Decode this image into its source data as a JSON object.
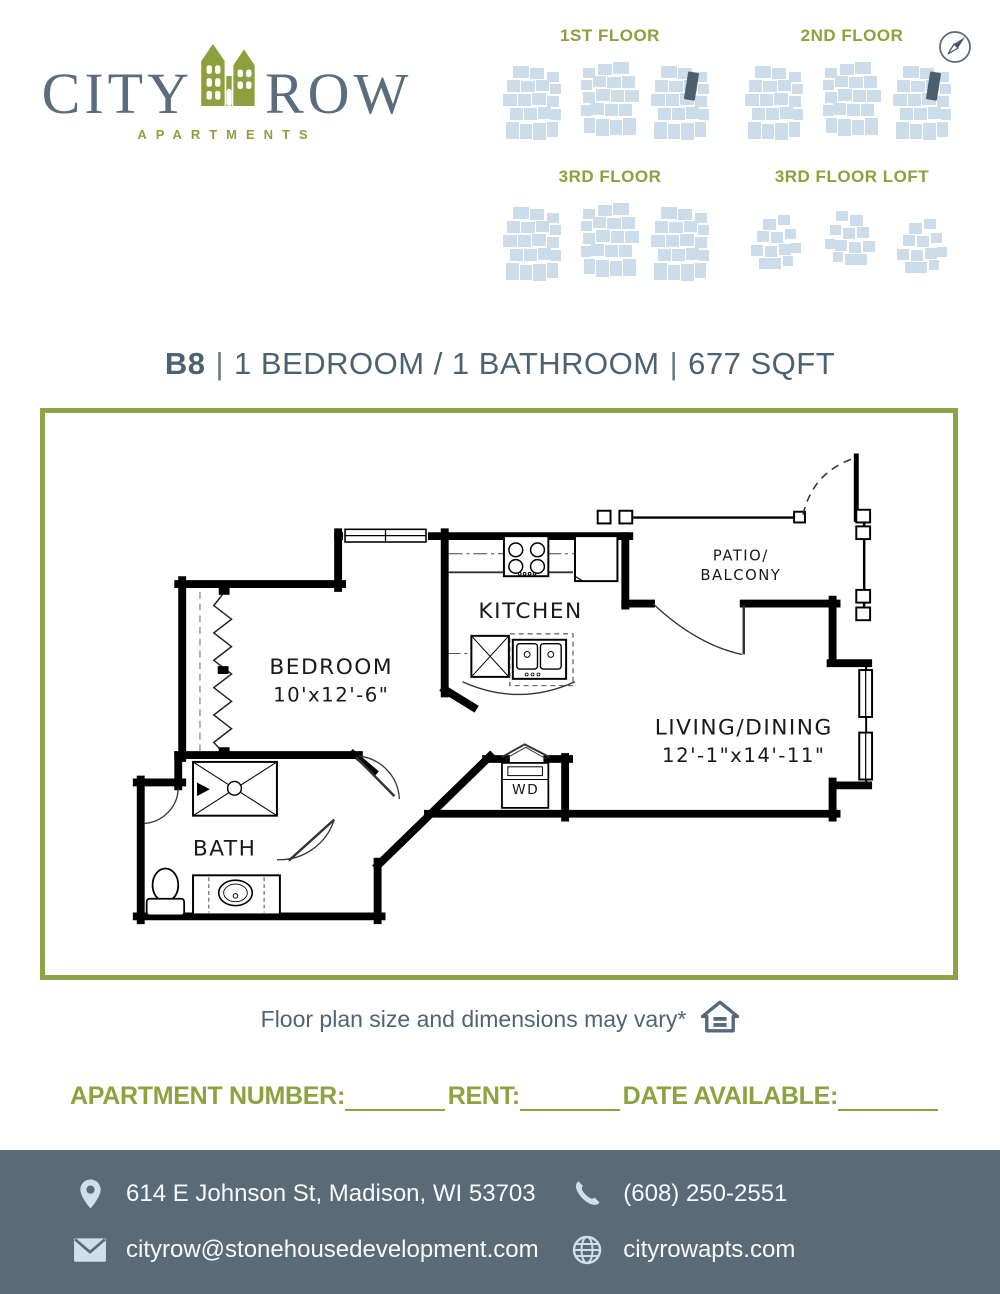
{
  "brand": {
    "name_left": "CITY",
    "name_right": "ROW",
    "tagline": "APARTMENTS",
    "logo_icon": "buildings-icon"
  },
  "colors": {
    "olive_green": "#8ca13e",
    "border_green": "#8ba446",
    "slate": "#5b6c7c",
    "title_slate": "#4c6271",
    "footer_background": "#5a6a77",
    "footprint_light_blue": "#ccdce9",
    "unit_highlight_dark": "#4b5f6e"
  },
  "floor_locator": {
    "compass_icon": "compass-icon",
    "floors": [
      {
        "label": "1ST FLOOR",
        "unit_highlighted": true
      },
      {
        "label": "2ND FLOOR",
        "unit_highlighted": true
      },
      {
        "label": "3RD FLOOR",
        "unit_highlighted": false
      },
      {
        "label": "3RD FLOOR LOFT",
        "unit_highlighted": false
      }
    ]
  },
  "unit_header": {
    "unit": "B8",
    "separator": "|",
    "bed_bath": "1 BEDROOM / 1 BATHROOM",
    "area": "677 SQFT"
  },
  "floor_plan": {
    "rooms": {
      "bedroom": {
        "label": "BEDROOM",
        "dims": "10'x12'-6\""
      },
      "kitchen": {
        "label": "KITCHEN"
      },
      "living": {
        "label": "LIVING/DINING",
        "dims": "12'-1\"x14'-11\""
      },
      "bath": {
        "label": "BATH"
      },
      "patio": {
        "line1": "PATIO/",
        "line2": "BALCONY"
      },
      "laundry": {
        "label": "WD"
      }
    },
    "note": "Floor plan size and dimensions may vary*",
    "equal_housing_icon": "equal-housing-icon"
  },
  "form": {
    "apartment_number_label": "APARTMENT NUMBER:",
    "rent_label": "RENT:",
    "date_available_label": "DATE AVAILABLE:"
  },
  "footer": {
    "address": "614 E Johnson St, Madison, WI 53703",
    "phone": "(608) 250-2551",
    "email": "cityrow@stonehousedevelopment.com",
    "website": "cityrowapts.com"
  }
}
